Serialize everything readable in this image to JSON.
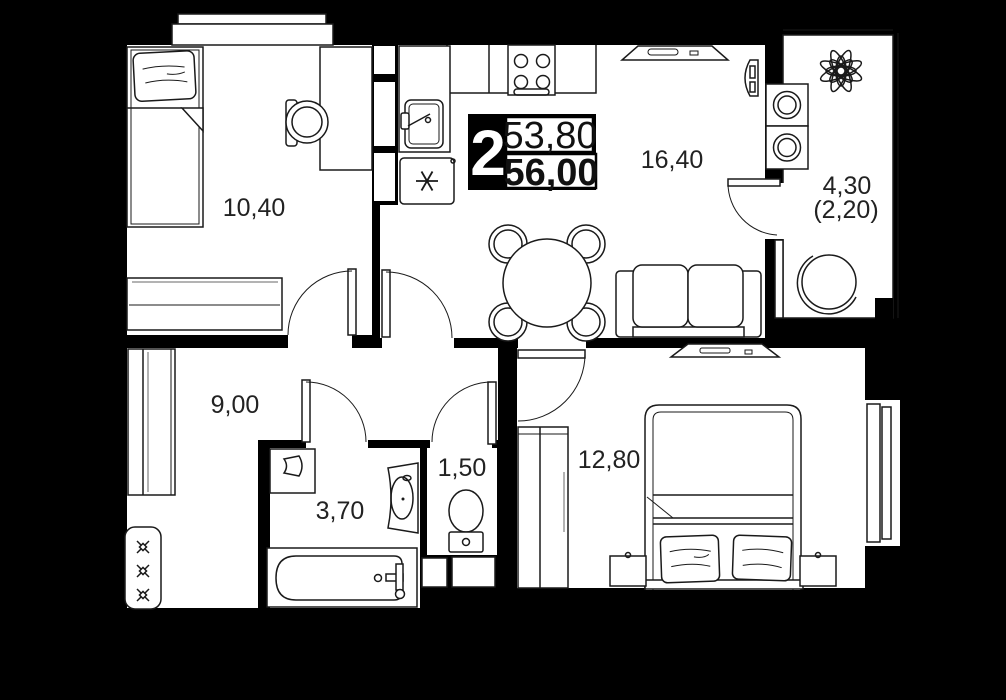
{
  "unit": {
    "rooms_count": "2",
    "area_upper": "53,80",
    "area_lower": "56,00"
  },
  "rooms": [
    {
      "name": "bedroom-1",
      "area": "10,40"
    },
    {
      "name": "kitchen-living-room",
      "area": "16,40"
    },
    {
      "name": "balcony",
      "area": "4,30",
      "area_secondary": "(2,20)"
    },
    {
      "name": "hallway",
      "area": "9,00"
    },
    {
      "name": "bathroom",
      "area": "3,70"
    },
    {
      "name": "wc",
      "area": "1,50"
    },
    {
      "name": "bedroom-2",
      "area": "12,80"
    }
  ],
  "colors": {
    "background": "#000000",
    "floor": "#ffffff",
    "line": "#1a1a1a",
    "label": "#222222"
  }
}
